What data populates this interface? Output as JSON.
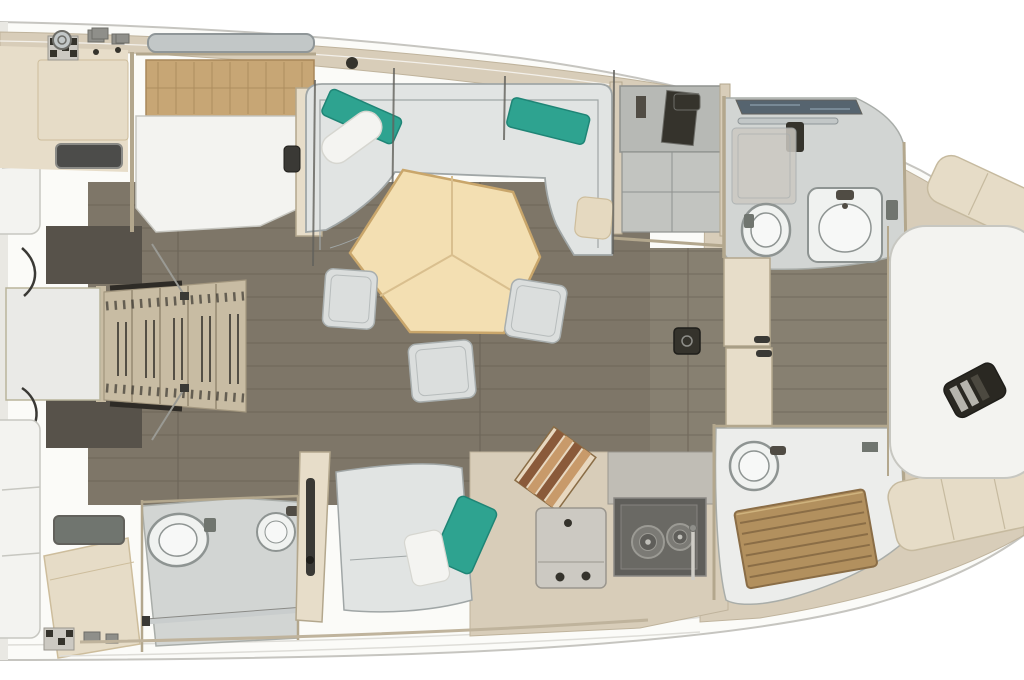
{
  "meta": {
    "type": "yacht-interior-floor-plan",
    "view": "top-down-3d-render",
    "orientation": "bow-right",
    "visible_text": []
  },
  "regions": [
    "hull",
    "foredeck",
    "bow-cabin",
    "port-forward-head",
    "starboard-forward-shower",
    "salon",
    "dinette-table",
    "galley",
    "nav-cabinet",
    "companionway",
    "port-aft-cabin",
    "port-aft-head",
    "starboard-aft-cabin",
    "starboard-aft-head",
    "aft-berths"
  ],
  "palette": {
    "bg": "#ffffff",
    "hullFill": "#fbfbf8",
    "hullLine": "#c6c5c0",
    "hullInner": "#deddd8",
    "hullEdgeBand": "#e9e8e3",
    "deck": "#d8cdb9",
    "deckLine": "#bfb39c",
    "deckSeat": "#e6dcc7",
    "deckSeatLine": "#c6ba9f",
    "wall": "#b3a78d",
    "wallLight": "#e7ddc9",
    "wallDark": "#62615c",
    "floor": "#7e7668",
    "floor2": "#878071",
    "floorSeam": "#635c50",
    "shadowDark": "#57524a",
    "stairs": "#c8bca3",
    "stairSlat": "#a2967e",
    "stairDark": "#2e2b26",
    "landing": "#eaeae7",
    "landingLine": "#b9b49b",
    "bedWhite": "#f3f3f0",
    "bedLine": "#c7c7c1",
    "headboard": "#c7a675",
    "headboardLine": "#a8875a",
    "window": "#4c4c4a",
    "windowFrame": "#8a8a86",
    "windowBlue": "#56646f",
    "windowBlueLight": "#8fa3b0",
    "hatchBar": "#c2c7c7",
    "hatchBarLine": "#8f9698",
    "sofa": "#e1e4e3",
    "sofaLine": "#a0a6a6",
    "teal": "#2ea390",
    "tealDark": "#1f8576",
    "pillow": "#f4f4f1",
    "pillowLine": "#d6d6d0",
    "tanCushion": "#e5d9c0",
    "tanCushionLine": "#cdbd9c",
    "table": "#f3dfb2",
    "tableEdge": "#c9a66b",
    "tableSeam": "#d9bf8e",
    "stool": "#dbdedd",
    "stoolLine": "#a8aeae",
    "bathFloor": "#d2d5d3",
    "bathFloorLine": "#a9ada9",
    "showerFloor": "#ecedeb",
    "fixture": "#f0f2f0",
    "fixtureInner": "#f7f8f7",
    "fixtureLine": "#8e9492",
    "metal": "#8f8f8a",
    "metalDark": "#6d6d68",
    "dark": "#35332c",
    "darker": "#1f1e1a",
    "grayFixture": "#70756f",
    "stove": "#5f5e5a",
    "stoveInner": "#6c6b66",
    "stoveEdge": "#8a8884",
    "burner": "#7b7a75",
    "burnerRing": "#9b9a94",
    "burnerDot": "#c0bfb9",
    "counterGray": "#ccc9c2",
    "counterLine": "#9a968e",
    "counterLight": "#c0bdb5",
    "teak": "#b2905e",
    "teakLine": "#8a6d46",
    "teakLight": "#cfb37e",
    "woodA": "#8a5a3a",
    "woodB": "#c89a6a",
    "woodC": "#e8d8c0",
    "cable": "#3a3935",
    "rope": "#9a9a94",
    "railBar": "#c9cdcd",
    "panelGray": "#b7b9b5",
    "panelGrayLine": "#8f928f",
    "panelGray2": "#c2c4c0",
    "itemDark": "#2a2822",
    "itemLight": "#cfcdc6",
    "itemMid": "#504c44"
  }
}
